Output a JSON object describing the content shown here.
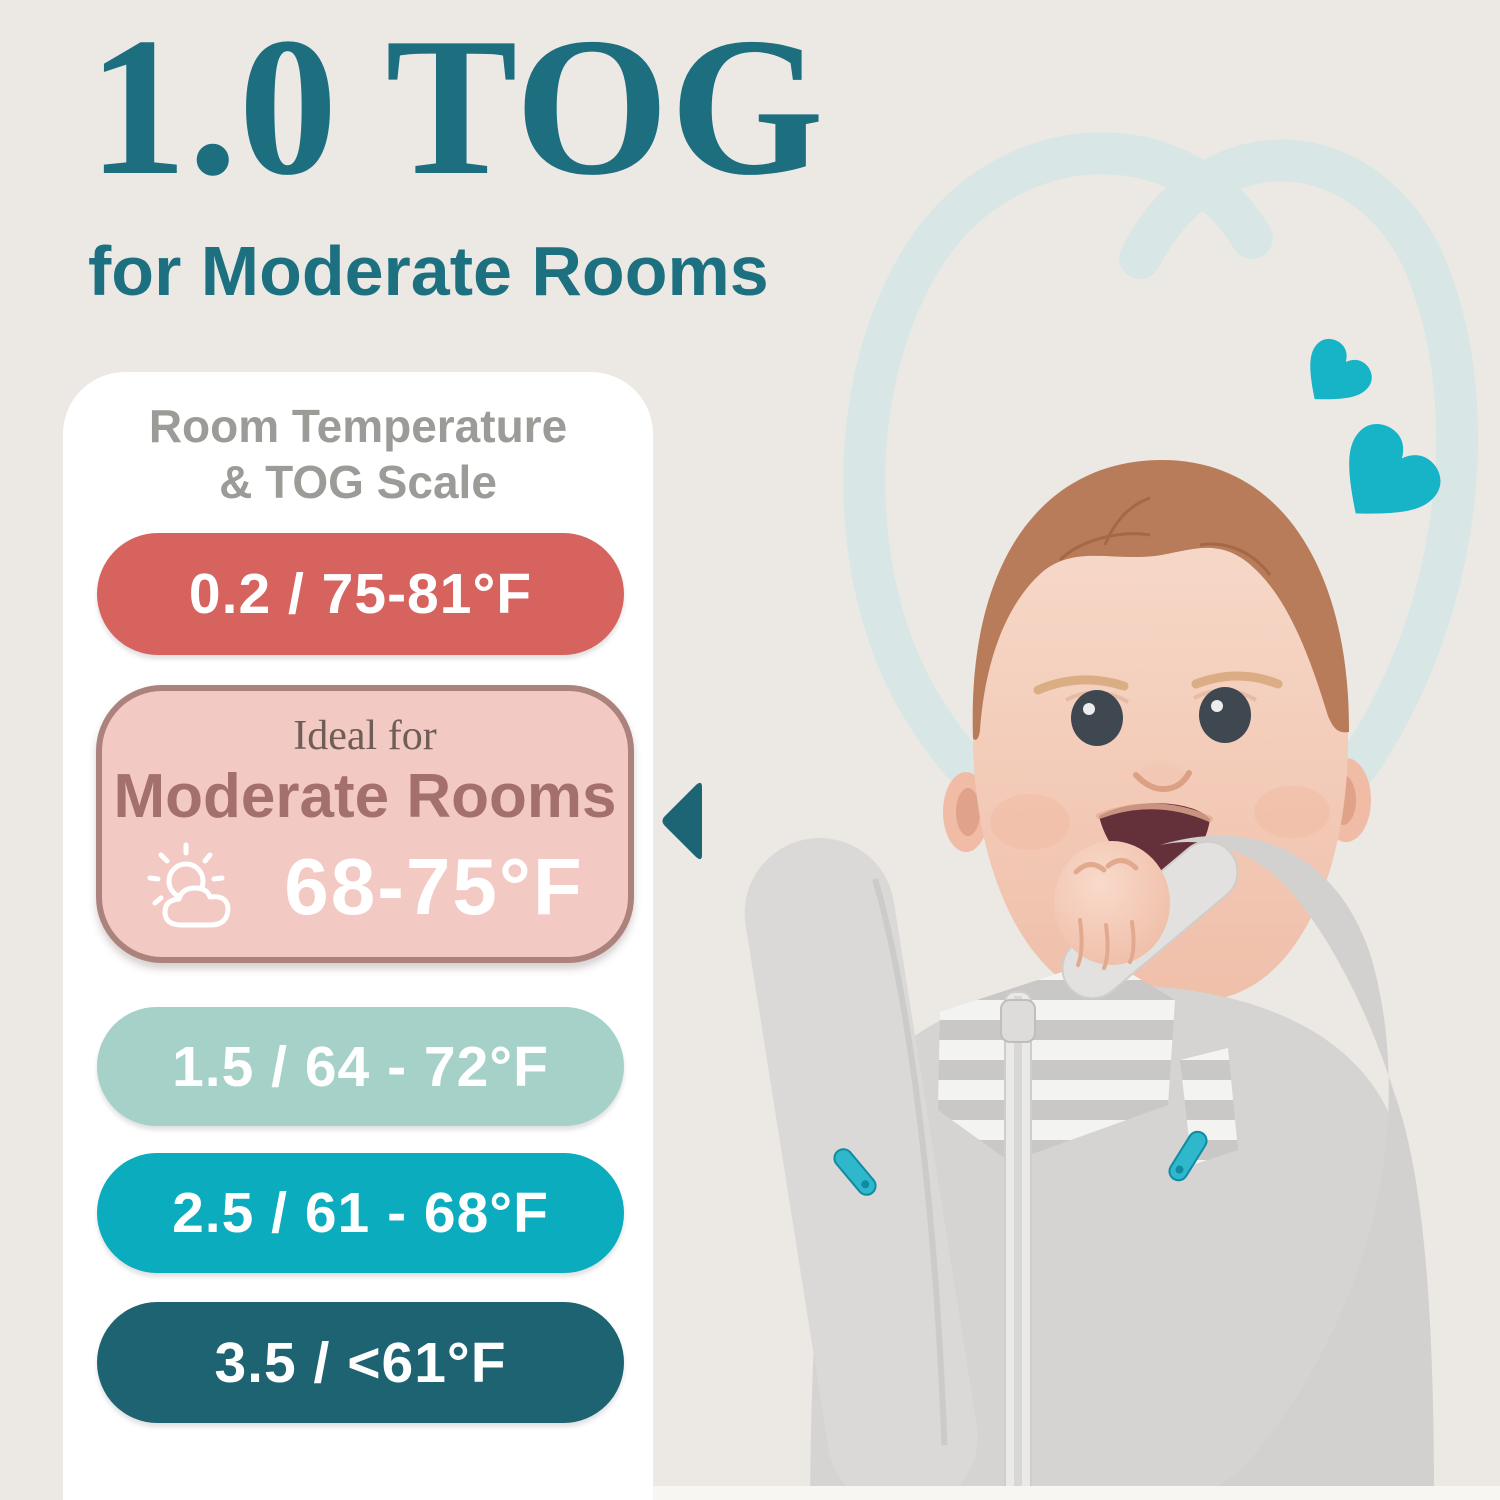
{
  "header": {
    "title": "1.0 TOG",
    "subtitle": "for Moderate Rooms"
  },
  "scale": {
    "heading_line1": "Room Temperature",
    "heading_line2": "& TOG Scale",
    "rows": [
      {
        "label": "0.2 / 75-81°F",
        "tog": "0.2",
        "temp_f": "75-81°F",
        "color": "#D7635E"
      },
      {
        "label": "1.5 / 64 - 72°F",
        "tog": "1.5",
        "temp_f": "64 - 72°F",
        "color": "#A5D1C8"
      },
      {
        "label": "2.5 / 61 - 68°F",
        "tog": "2.5",
        "temp_f": "61 - 68°F",
        "color": "#0BACBE"
      },
      {
        "label": "3.5 / <61°F",
        "tog": "3.5",
        "temp_f": "<61°F",
        "color": "#1E6372"
      }
    ],
    "ideal": {
      "prefix": "Ideal for",
      "room_type": "Moderate Rooms",
      "temp_f": "68-75°F",
      "icon": "sun-behind-cloud-icon",
      "bg_color": "#F3C9C4",
      "border_color": "#AC837C"
    }
  },
  "decor": {
    "background_color": "#ECE9E4",
    "title_color": "#1D6F80",
    "heart_color": "#17B3C7",
    "heart_outline_color": "#D8E7E6",
    "pointer_color": "#1D6474"
  },
  "photo": {
    "description": "Smiling baby with hand in mouth wearing a gray arms-up swaddle sleep sack with striped chest panel, center zipper and teal zipper pulls"
  }
}
